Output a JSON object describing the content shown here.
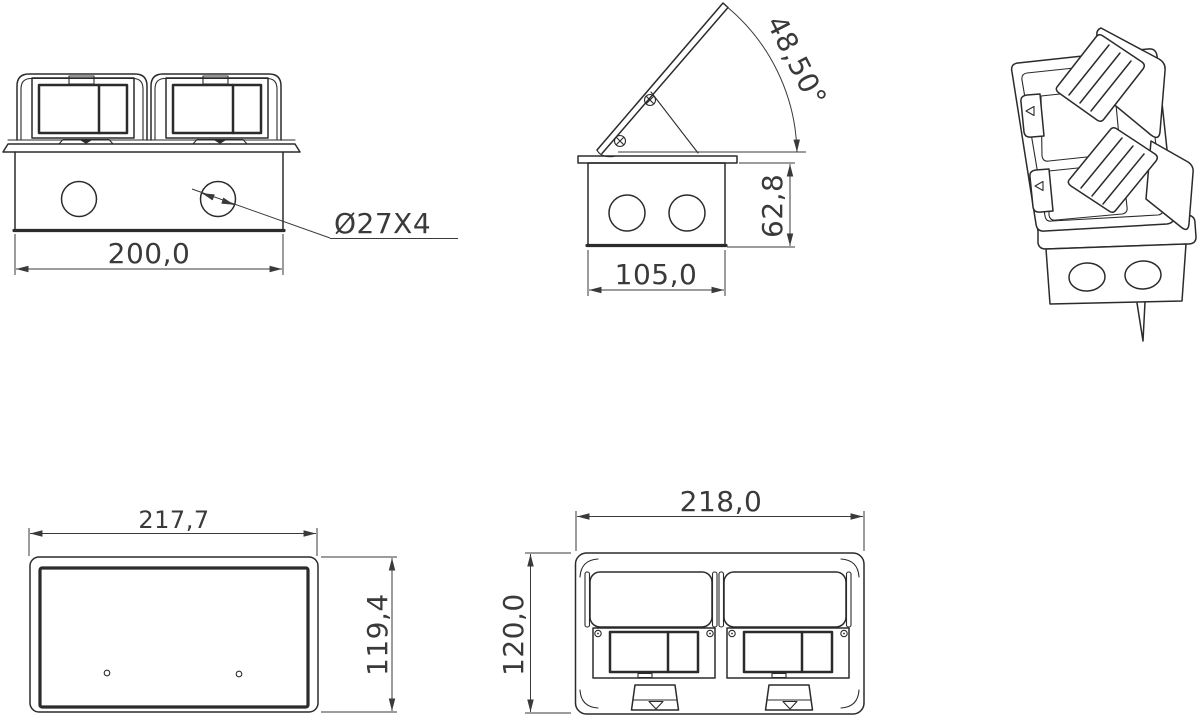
{
  "drawing": {
    "views": {
      "front": {
        "width_dim": "200,0",
        "hole_callout": "Ø27X4"
      },
      "side": {
        "angle_dim": "48,50°",
        "width_dim": "105,0",
        "height_dim": "62,8"
      },
      "back": {
        "width_dim": "217,7",
        "height_dim": "119,4"
      },
      "top": {
        "width_dim": "218,0",
        "height_dim": "120,0"
      }
    }
  },
  "colors": {
    "line": "#2b2b2b",
    "dim": "#3a3a3a",
    "bg": "#ffffff"
  }
}
